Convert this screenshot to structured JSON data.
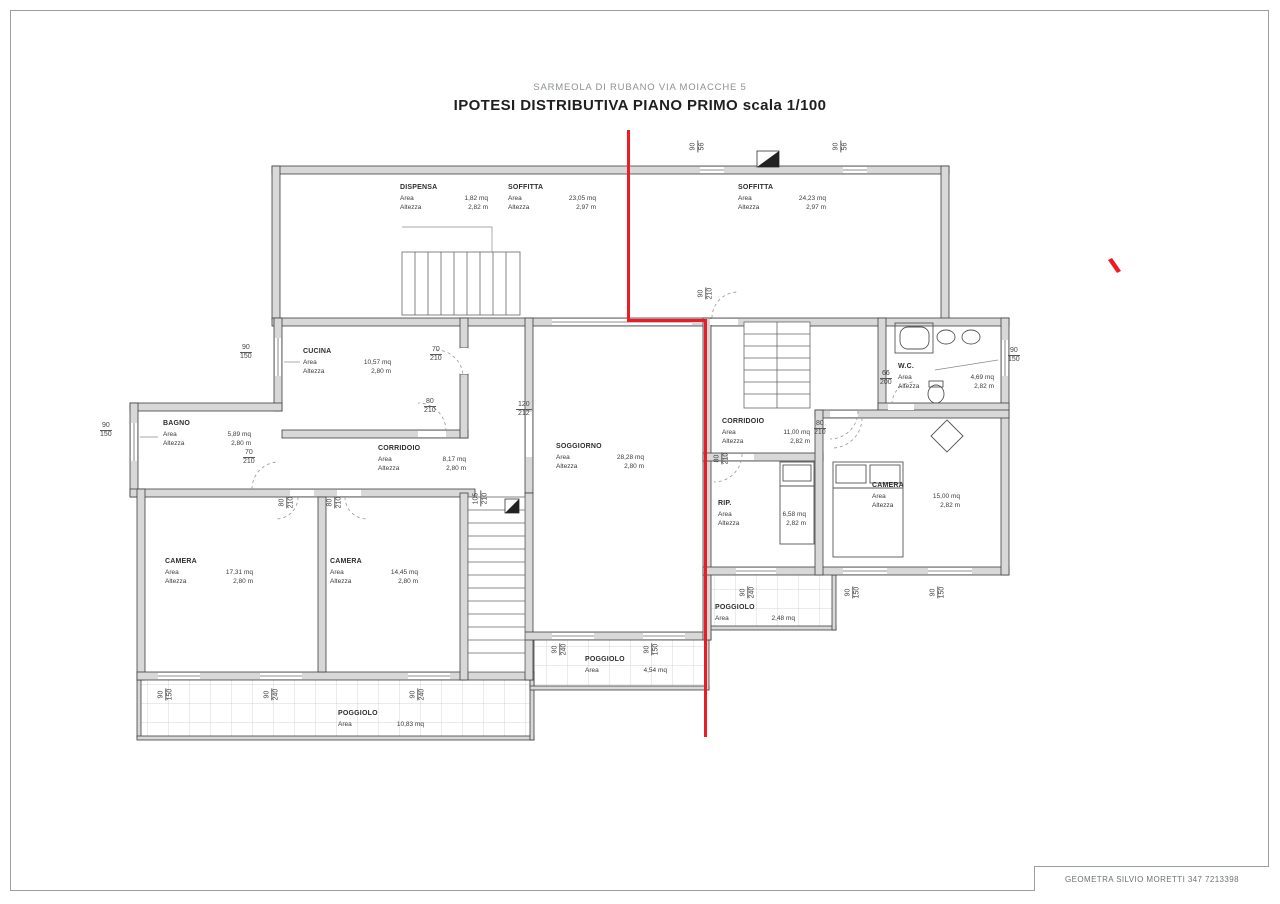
{
  "page": {
    "subtitle": "SARMEOLA DI RUBANO VIA MOIACCHE 5",
    "title": "IPOTESI DISTRIBUTIVA PIANO PRIMO scala 1/100",
    "footer": "GEOMETRA SILVIO MORETTI 347 7213398"
  },
  "field_labels": {
    "area": "Area",
    "height": "Altezza"
  },
  "rooms": [
    {
      "name": "DISPENSA",
      "area": "1,82 mq",
      "height": "2,82 m"
    },
    {
      "name": "SOFFITTA",
      "area": "23,05 mq",
      "height": "2,97 m"
    },
    {
      "name": "SOFFITTA",
      "area": "24,23 mq",
      "height": "2,97 m"
    },
    {
      "name": "CUCINA",
      "area": "10,57 mq",
      "height": "2,80 m"
    },
    {
      "name": "BAGNO",
      "area": "5,89 mq",
      "height": "2,80 m"
    },
    {
      "name": "CORRIDOIO",
      "area": "8,17 mq",
      "height": "2,80 m"
    },
    {
      "name": "SOGGIORNO",
      "area": "28,28 mq",
      "height": "2,80 m"
    },
    {
      "name": "CAMERA",
      "area": "17,31 mq",
      "height": "2,80 m"
    },
    {
      "name": "CAMERA",
      "area": "14,45 mq",
      "height": "2,80 m"
    },
    {
      "name": "W.C.",
      "area": "4,69 mq",
      "height": "2,82 m"
    },
    {
      "name": "CORRIDOIO",
      "area": "11,00 mq",
      "height": "2,82 m"
    },
    {
      "name": "RIP.",
      "area": "6,58 mq",
      "height": "2,82 m"
    },
    {
      "name": "CAMERA",
      "area": "15,00 mq",
      "height": "2,82 m"
    }
  ],
  "balconies": [
    {
      "name": "POGGIOLO",
      "area": "2,48 mq"
    },
    {
      "name": "POGGIOLO",
      "area": "4,54 mq"
    },
    {
      "name": "POGGIOLO",
      "area": "10,83 mq"
    }
  ],
  "dimensions": [
    {
      "top": "90",
      "bottom": "56"
    },
    {
      "top": "90",
      "bottom": "56"
    },
    {
      "top": "90",
      "bottom": "150"
    },
    {
      "top": "90",
      "bottom": "150"
    },
    {
      "top": "70",
      "bottom": "210"
    },
    {
      "top": "80",
      "bottom": "210"
    },
    {
      "top": "70",
      "bottom": "210"
    },
    {
      "top": "120",
      "bottom": "212"
    },
    {
      "top": "80",
      "bottom": "210"
    },
    {
      "top": "66",
      "bottom": "200"
    },
    {
      "top": "90",
      "bottom": "150"
    },
    {
      "top": "90",
      "bottom": "210"
    },
    {
      "top": "80",
      "bottom": "210"
    },
    {
      "top": "80",
      "bottom": "210"
    },
    {
      "top": "80",
      "bottom": "210"
    },
    {
      "top": "105",
      "bottom": "210"
    },
    {
      "top": "90",
      "bottom": "240"
    },
    {
      "top": "90",
      "bottom": "150"
    },
    {
      "top": "90",
      "bottom": "150"
    },
    {
      "top": "90",
      "bottom": "240"
    },
    {
      "top": "90",
      "bottom": "150"
    },
    {
      "top": "90",
      "bottom": "150"
    },
    {
      "top": "90",
      "bottom": "240"
    },
    {
      "top": "90",
      "bottom": "240"
    }
  ],
  "colors": {
    "section_line": "#ed1c24",
    "wall_fill": "#d8d8d8",
    "wall_stroke": "#3f3f3f"
  }
}
